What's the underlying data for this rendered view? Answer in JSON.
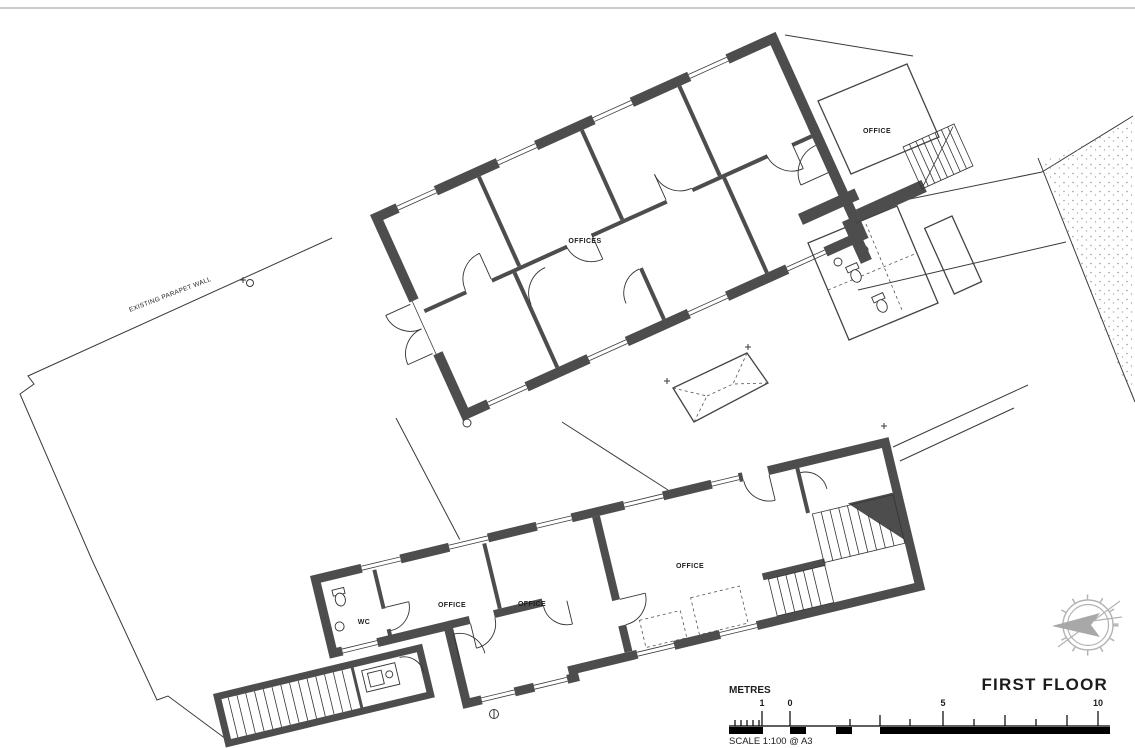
{
  "title": "FIRST FLOOR",
  "site": {
    "parapet_label": "EXISTING PARAPET WALL"
  },
  "rooms": {
    "offices_hall": "OFFICES",
    "office_top_right": "OFFICE",
    "office_lower_main": "OFFICE",
    "office_lower_1": "OFFICE",
    "office_lower_2": "OFFICE",
    "wc": "WC"
  },
  "scale_bar": {
    "units_label": "METRES",
    "scale_text": "SCALE 1:100 @ A3",
    "tick_labels": [
      "1",
      "0",
      "5",
      "10"
    ]
  },
  "icons": {
    "compass": "compass-rose-icon"
  },
  "colors": {
    "wall": "#4d4d4d",
    "thin_line": "#3a3a3a",
    "light_line": "#cccccc",
    "stipple": "#9a9a9a",
    "compass": "#b3b3b3",
    "text": "#1c1c1c"
  }
}
